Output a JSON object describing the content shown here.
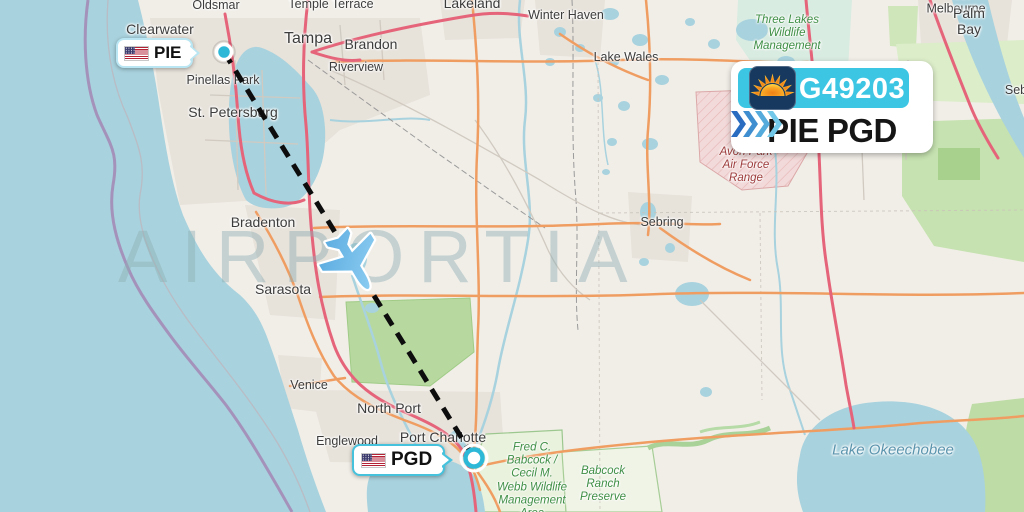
{
  "watermark": "AIRPORTIA",
  "route_card": {
    "flight_number": "G49203",
    "origin_code": "PIE",
    "destination_code": "PGD",
    "airline_logo": "sun-country-sun-icon",
    "banner_color": "#3cc6e4",
    "logo_bg_color": "#17395f",
    "chevron_colors": [
      "#2a6cc0",
      "#3e8ed0",
      "#55acdc",
      "#72c8e8"
    ]
  },
  "origin_pill": {
    "code": "PIE",
    "flag": "us-flag"
  },
  "dest_pill": {
    "code": "PGD",
    "flag": "us-flag"
  },
  "map": {
    "colors": {
      "land": "#f1eee8",
      "water": "#a8d2de",
      "urban": "#e9e5de",
      "green": "#b7d9a0",
      "military_area": "#f3dada",
      "motorway": "#e5647a",
      "trunk": "#f09d62",
      "route_dash": "#0d0d0d",
      "marker_teal": "#2db8d8"
    },
    "labels": [
      {
        "text": "Oldsmar"
      },
      {
        "text": "Temple Terrace"
      },
      {
        "text": "Lakeland"
      },
      {
        "text": "Winter Haven"
      },
      {
        "text": "Clearwater"
      },
      {
        "text": "Tampa"
      },
      {
        "text": "Brandon"
      },
      {
        "text": "Riverview"
      },
      {
        "text": "Lake Wales"
      },
      {
        "text": "West Melbourne"
      },
      {
        "text": "Palm Bay"
      },
      {
        "text": "Seb"
      },
      {
        "text": "Pinellas Park"
      },
      {
        "text": "St. Petersburg"
      },
      {
        "text": "Bradenton"
      },
      {
        "text": "Sarasota"
      },
      {
        "text": "Sebring"
      },
      {
        "text": "Venice"
      },
      {
        "text": "North Port"
      },
      {
        "text": "Englewood"
      },
      {
        "text": "Port Charlotte"
      },
      {
        "text": "Lake Okeechobee"
      },
      {
        "text": "Three Lakes\nWildlife\nManagement"
      },
      {
        "text": "Avon Park\nAir Force\nRange"
      },
      {
        "text": "Fred C.\nBabcock /\nCecil M.\nWebb Wildlife\nManagement\nArea"
      },
      {
        "text": "Babcock\nRanch\nPreserve"
      }
    ]
  }
}
